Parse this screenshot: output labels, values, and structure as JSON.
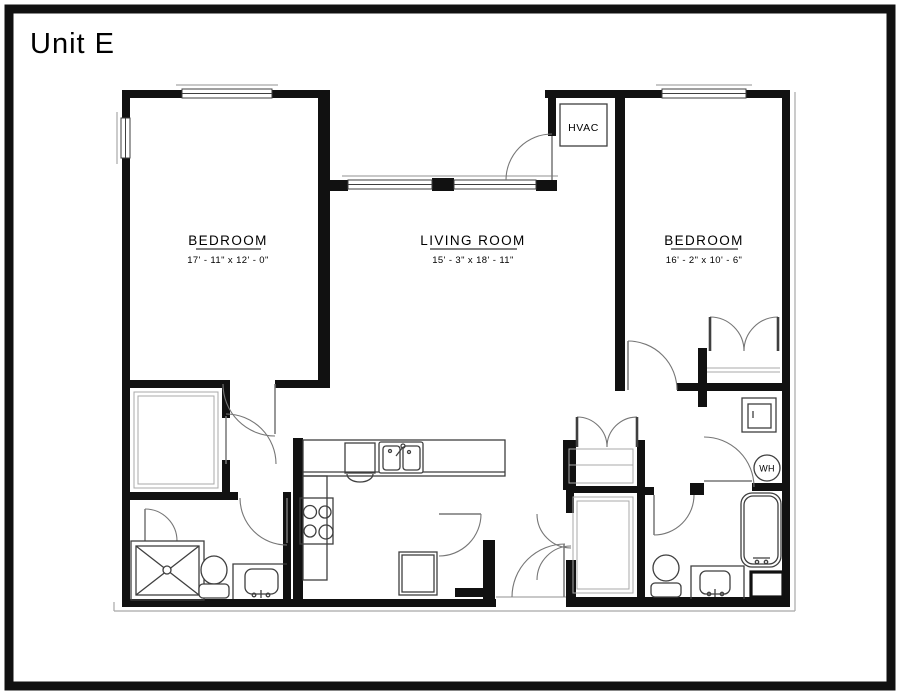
{
  "title": "Unit E",
  "rooms": {
    "bedroom_left": {
      "name": "BEDROOM",
      "dims": "17' - 11\" x 12' - 0\""
    },
    "living_room": {
      "name": "LIVING ROOM",
      "dims": "15' - 3\" x 18' - 11\""
    },
    "bedroom_right": {
      "name": "BEDROOM",
      "dims": "16' - 2\" x 10' - 6\""
    },
    "hvac_closet": {
      "label": "HVAC"
    },
    "water_heater": {
      "label": "WH"
    }
  },
  "colors": {
    "wall": "#111111",
    "line": "#3f3f3f",
    "arc": "#767676",
    "faint": "#a8a8a8",
    "background": "#ffffff"
  }
}
